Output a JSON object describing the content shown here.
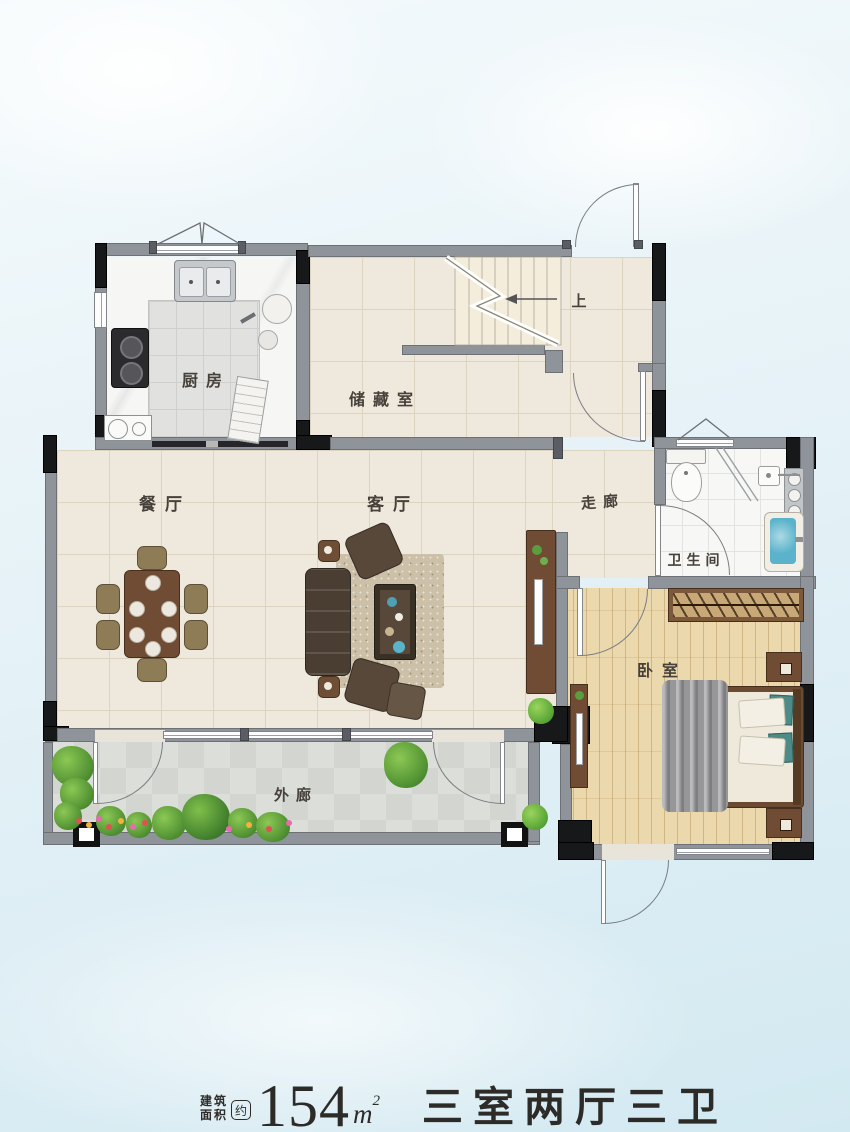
{
  "plan": {
    "rooms": {
      "kitchen": {
        "label": "厨房"
      },
      "storage": {
        "label": "储藏室"
      },
      "dining": {
        "label": "餐厅"
      },
      "living": {
        "label": "客厅"
      },
      "corridor": {
        "label": "走廊"
      },
      "bathroom": {
        "label": "卫生间"
      },
      "bedroom": {
        "label": "卧室"
      },
      "veranda": {
        "label": "外廊"
      }
    },
    "stairs": {
      "direction_label": "上"
    }
  },
  "caption": {
    "area_label_line1": "建筑",
    "area_label_line2": "面积",
    "approx_mark": "约",
    "area_value": "154",
    "area_unit": "m",
    "area_unit_exponent": "2",
    "layout_summary": "三室两厅三卫"
  },
  "palette": {
    "wall_gray": "#8f939a",
    "wall_black": "#17181a",
    "tile_beige": "#efe8dc",
    "wood_floor": "#ebd8ad",
    "bathtub_blue": "#5ab3ca",
    "plant_green": "#5a9e3e"
  }
}
